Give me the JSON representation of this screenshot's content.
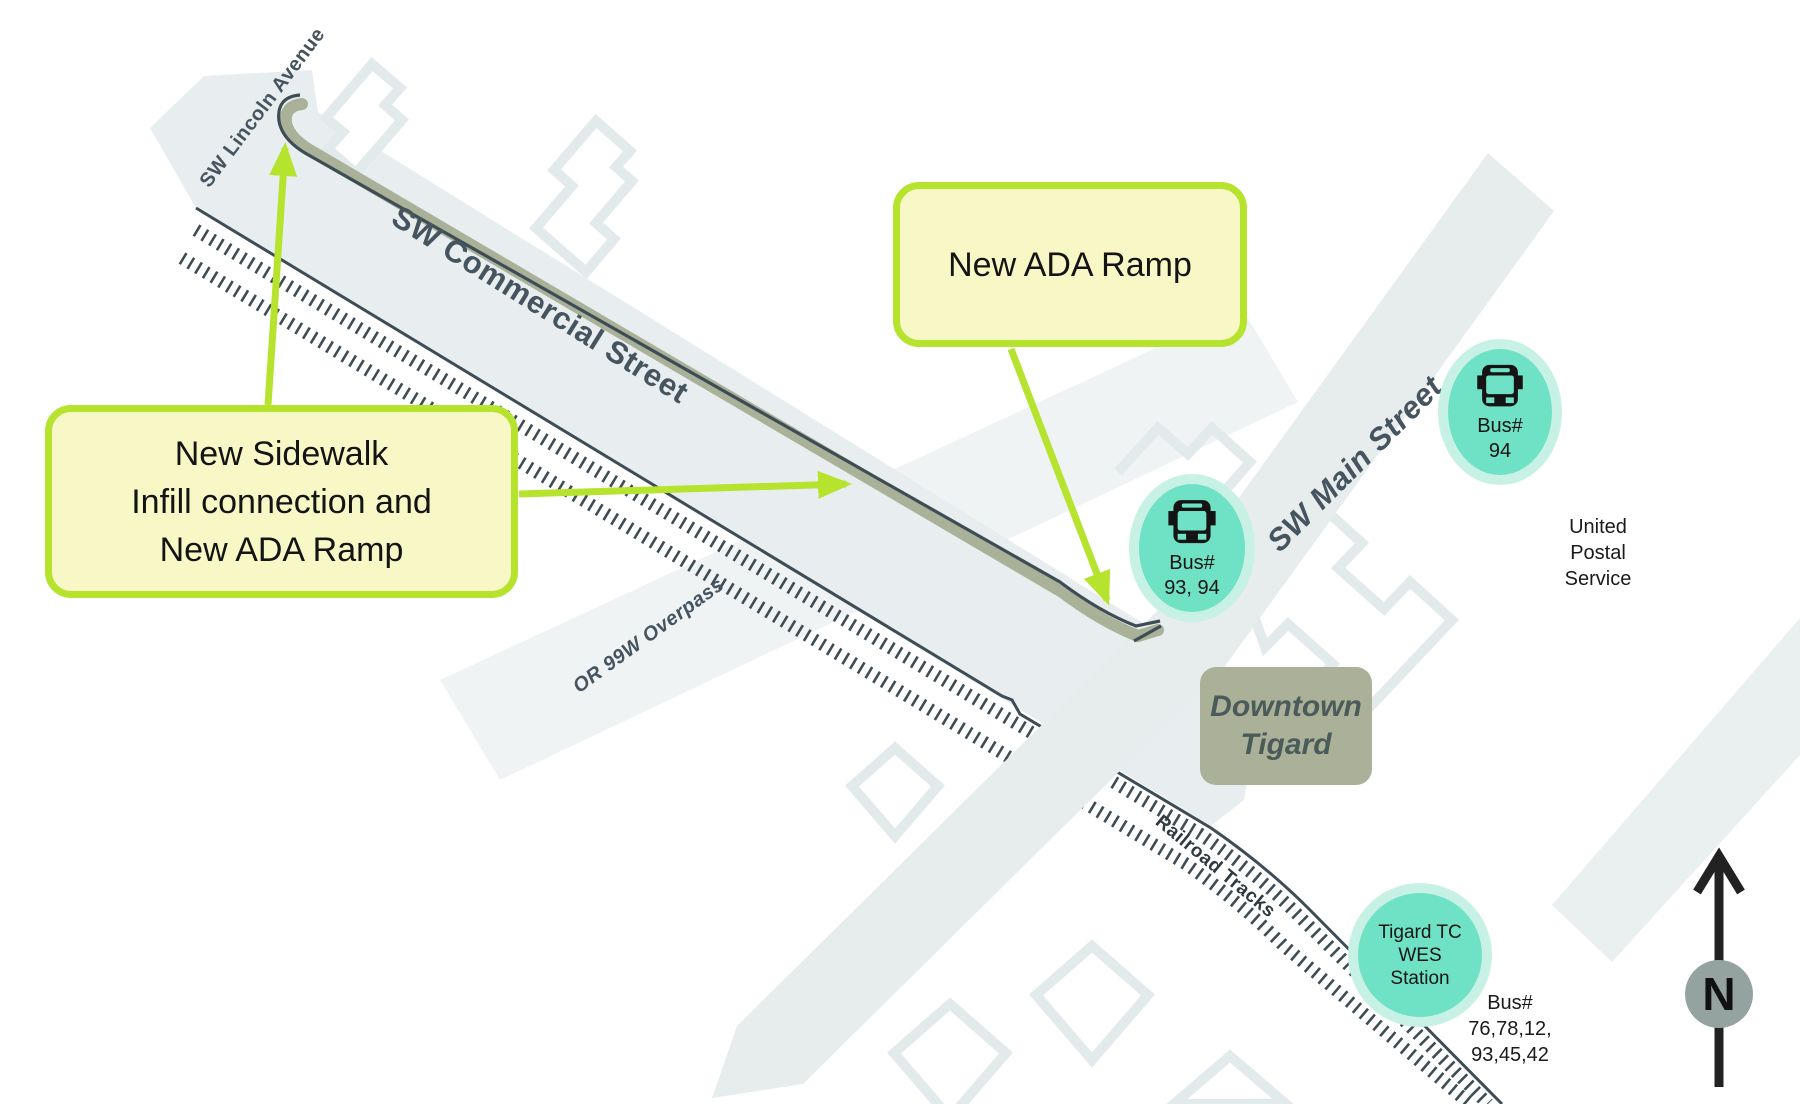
{
  "map_title": "Downtown Tigard sidewalk and ADA ramp improvements map",
  "callouts": {
    "sidewalk_infill": {
      "lines": [
        "New Sidewalk",
        "Infill connection and",
        "New ADA Ramp"
      ]
    },
    "ada_ramp": {
      "label": "New ADA Ramp"
    }
  },
  "street_labels": {
    "lincoln": "SW Lincoln Avenue",
    "commercial": "SW Commercial Street",
    "main": "SW Main Street",
    "overpass": "OR 99W Overpass",
    "railroad": "Railroad Tracks"
  },
  "bus_stops": {
    "stop_93_94": {
      "lines": [
        "Bus#",
        "93, 94"
      ]
    },
    "stop_94": {
      "lines": [
        "Bus#",
        "94"
      ]
    },
    "wes_station": {
      "lines": [
        "Tigard TC",
        "WES",
        "Station"
      ]
    },
    "wes_station_routes": {
      "lines": [
        "Bus#",
        "76,78,12,",
        "93,45,42"
      ]
    }
  },
  "areas": {
    "downtown": {
      "lines": [
        "Downtown",
        "Tigard"
      ]
    },
    "usps": {
      "lines": [
        "United",
        "Postal",
        "Service"
      ]
    }
  },
  "compass": {
    "label": "N"
  },
  "icons": {
    "bus": "bus-icon",
    "north": "north-arrow-icon"
  },
  "colors": {
    "accent_green": "#b6e32e",
    "callout_fill": "#f8f8c6",
    "teal_stop": "#6fe2c5",
    "teal_halo": "#c8f1e6",
    "sidewalk_olive": "#a9b199",
    "street_fill": "#e8eeef",
    "overpass_fill": "#eff3f4",
    "main_street_fill": "#e7eced",
    "map_outline": "#3e4d55",
    "building_outline": "#e3eaeb",
    "label_text": "#45545e",
    "downtown_fill": "#abb099",
    "compass_circle": "#95a3a0"
  }
}
